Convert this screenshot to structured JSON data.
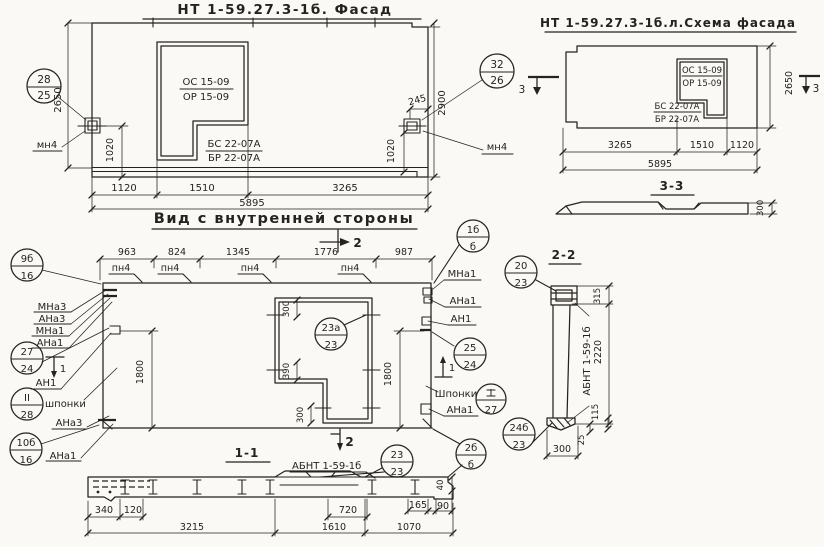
{
  "facade": {
    "title": "НТ 1-59.27.3-1б. Фасад",
    "window_mark_1": "ОС 15-09",
    "window_mark_2": "ОР 15-09",
    "door_mark_1": "БС 22-07А",
    "door_mark_2": "БР 22-07А",
    "callout_left": {
      "top": "28",
      "bottom": "25"
    },
    "callout_right": {
      "top": "32",
      "bottom": "26"
    },
    "anchor_label_left": "мн4",
    "anchor_label_right": "мн4",
    "dim_height_face": "2650",
    "dim_height_total": "2900",
    "dim_anchor_left": "1020",
    "dim_anchor_right": "1020",
    "dim_anchor_top": "245",
    "dims_bottom": [
      "1120",
      "1510",
      "3265"
    ],
    "dim_total": "5895"
  },
  "scheme": {
    "title": "НТ 1-59.27.3-1б.л.Схема фасада",
    "window_mark_1": "ОС 15-09",
    "window_mark_2": "ОР 15-09",
    "door_mark_1": "БС 22-07А",
    "door_mark_2": "БР 22-07А",
    "dim_height": "2650",
    "marker_left": "3",
    "marker_right": "3",
    "dims_bottom": [
      "3265",
      "1510",
      "1120"
    ],
    "dim_total": "5895",
    "section": {
      "title": "3-3",
      "dim_thickness": "300"
    }
  },
  "inner": {
    "title": "Вид с внутренней стороны",
    "dims_top": [
      "963",
      "824",
      "1345",
      "1776",
      "987"
    ],
    "pn_labels": [
      "пн4",
      "пн4",
      "пн4",
      "пн4"
    ],
    "marker_top": "2",
    "callout_corner": {
      "top": "1б",
      "bottom": "б"
    },
    "callout_9b": {
      "top": "9б",
      "bottom": "16"
    },
    "labels_left": [
      "МНа3",
      "АНа3",
      "МНа1",
      "АНа1"
    ],
    "callout_27": {
      "top": "27",
      "bottom": "24"
    },
    "marker_1_left": "1",
    "label_an1_left": "АН1",
    "callout_keys": {
      "top": "II",
      "bottom": "28"
    },
    "label_keys_left": "шпонки",
    "label_ana3_left": "АНа3",
    "callout_10b": {
      "top": "10б",
      "bottom": "16"
    },
    "label_ana1_left": "АНа1",
    "labels_right": [
      "МНа1",
      "АНа1",
      "АН1"
    ],
    "callout_25": {
      "top": "25",
      "bottom": "24"
    },
    "marker_1_right": "1",
    "label_keys_right": "Шпонки",
    "callout_keys_right": {
      "top": "I",
      "bottom": "27"
    },
    "label_ana1_right": "АНа1",
    "dim_height": "1800",
    "dim_height_2": "1800",
    "window_dims": [
      "300",
      "390",
      "300"
    ],
    "callout_window": {
      "top": "23а",
      "bottom": "23"
    }
  },
  "section22": {
    "title": "2-2",
    "callout_top": {
      "top": "20",
      "bottom": "23"
    },
    "dim_315": "315",
    "dim_2220": "2220",
    "dim_115": "115",
    "dim_25": "25",
    "dim_300": "300",
    "part_label": "АБНТ 1-59-1б",
    "callout_bottom": {
      "top": "24б",
      "bottom": "23"
    }
  },
  "section11": {
    "title": "1-1",
    "part_label": "АБНТ 1-59-1б",
    "marker_bottom": "2",
    "callout_sill": {
      "top": "23",
      "bottom": "23"
    },
    "callout_end": {
      "top": "2б",
      "bottom": "б"
    },
    "dims_row1": [
      "340",
      "120",
      "720",
      "165",
      "90"
    ],
    "dims_row2": [
      "3215",
      "1610",
      "1070"
    ],
    "dim_40": "40"
  }
}
